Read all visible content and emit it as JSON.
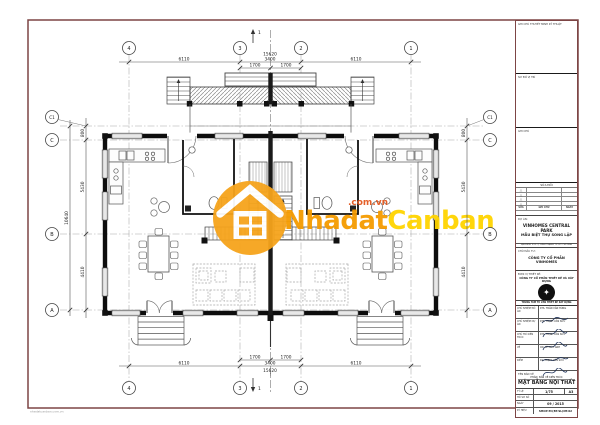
{
  "watermark": {
    "brand_a": "Nhadat",
    "brand_b": "Canban",
    "domain": ".com.vn"
  },
  "footer_note": "nhadatcanban.com.vn",
  "plan": {
    "grid_cols": [
      "4",
      "3",
      "2",
      "1"
    ],
    "grid_rows": [
      "C1",
      "C",
      "B",
      "A"
    ],
    "dims": {
      "span_lr": "6110",
      "mid": "3400",
      "half": "1700",
      "total_width": "15620",
      "row_c1c": "800",
      "row_cb": "5430",
      "row_ba": "4410",
      "total_height": "10640"
    },
    "section_label": "1"
  },
  "title_block": {
    "box_notes_label": "GHI CHÚ THUYẾT MINH KỸ THUẬT",
    "box_location_label": "SƠ ĐỒ VỊ TRÍ",
    "box_legend_label": "GHI CHÚ",
    "revisions": {
      "title": "SỬA ĐỔI",
      "symbol": "△",
      "columns": [
        "SỬA",
        "GHI CHÚ",
        "NGÀY"
      ]
    },
    "project": {
      "label": "DỰ ÁN:",
      "name1": "VINHOMES CENTRAL PARK",
      "name2": "MẪU BIỆT THỰ SONG LẬP",
      "address": "ĐỊA ĐIỂM: P.22, Q. BÌNH THẠNH, TP. HỒ CHÍ MINH"
    },
    "client": {
      "label": "CHỦ ĐẦU TƯ:",
      "name": "CÔNG TY CỔ PHẦN VINHOMES"
    },
    "designer": {
      "label": "ĐƠN VỊ THIẾT KẾ:",
      "name1": "CÔNG TY CỔ PHẦN THIẾT KẾ VÀ XÂY DỰNG",
      "strip": "TRUNG TÂM TƯ VẤN THIẾT KẾ XÂY DỰNG"
    },
    "signatures": [
      {
        "role": "CHỦ NHIỆM ĐỒ ÁN",
        "name": "KTS. TRẦN VĂN HÙNG"
      },
      {
        "role": "CHỦ NHIỆM DỰ ÁN",
        "name": "KTS. TRỊNH VĂN SỬU"
      },
      {
        "role": "CHỦ TRÌ KIẾN TRÚC",
        "name": "KTS. TRỊNH VĂN SỬU"
      },
      {
        "role": "VẼ",
        "name": "CN. LÊ ĐỨC ANH"
      },
      {
        "role": "KIỂM",
        "name": "KS. TRỊNH VĂN SỬU"
      }
    ],
    "drawing": {
      "label": "TÊN BẢN VẼ",
      "phase": "PHẦN: BẢN VẼ KIẾN TRÚC",
      "title": "MẶT BẰNG NỘI THẤT T1"
    },
    "meta": {
      "scale_label": "TỶ LỆ",
      "scale": "1/75",
      "size": "A3",
      "dossier_label": "HỒ SƠ SỐ",
      "dossier": "",
      "date_label": "NGÀY",
      "date": "09 / 2015",
      "code_label": "KÝ HIỆU",
      "code": "SHOP-TC(BT.SL)NT.02"
    }
  }
}
